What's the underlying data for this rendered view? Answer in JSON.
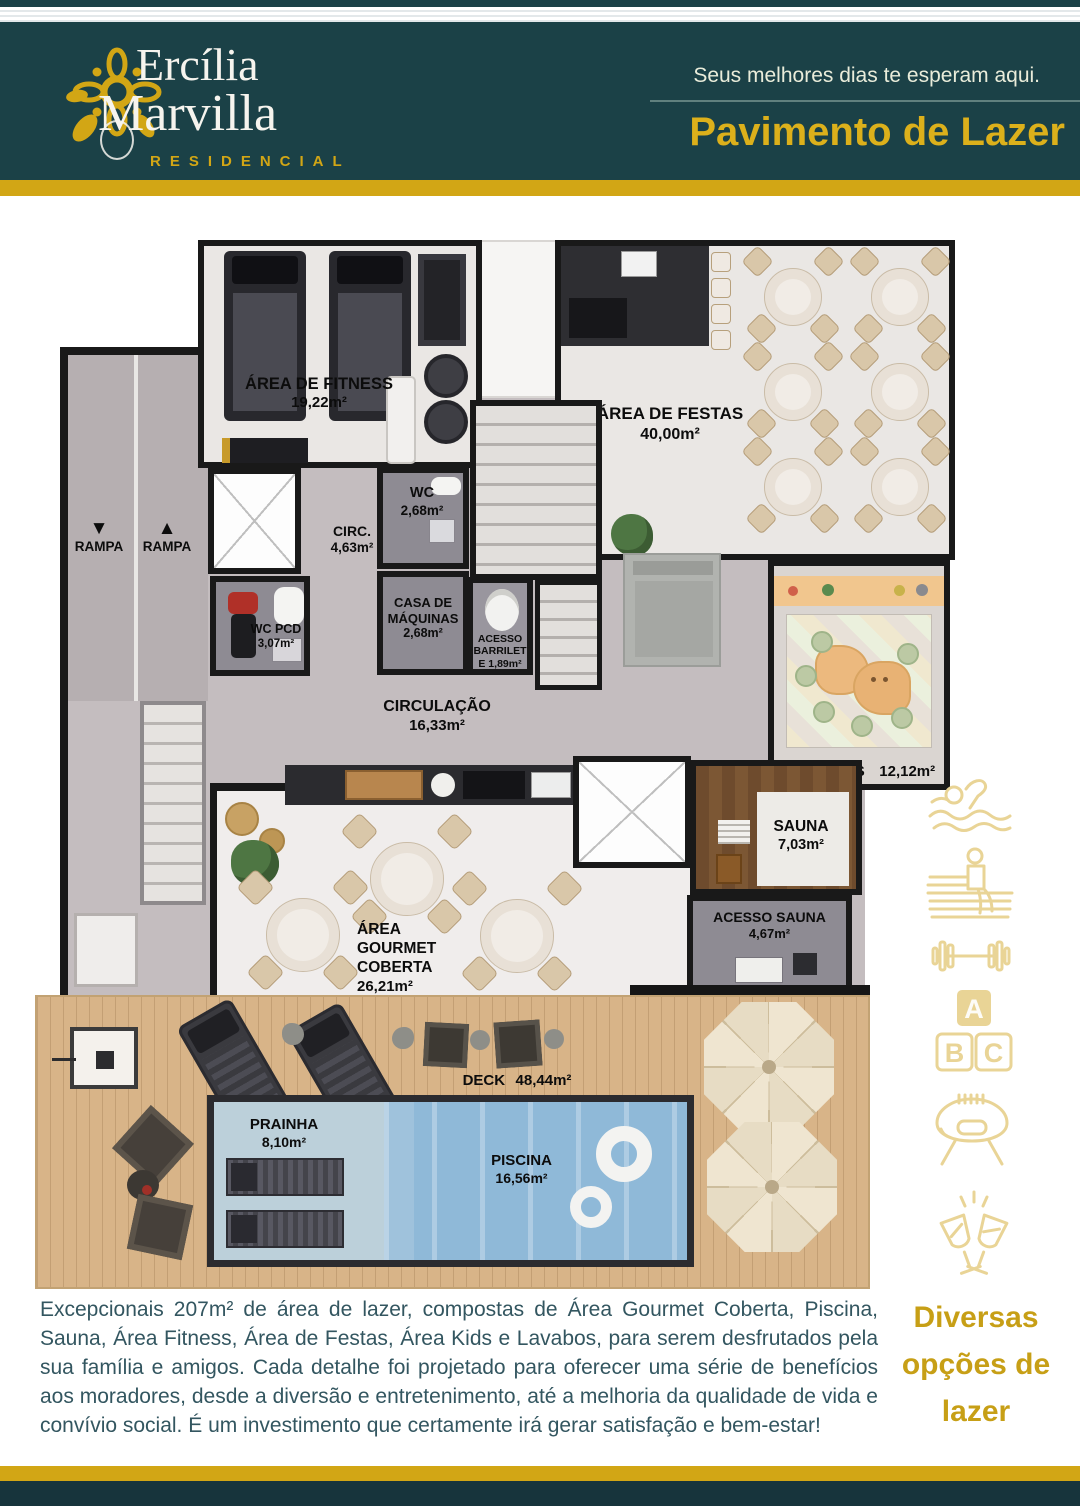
{
  "header": {
    "brand_line1": "Ercília",
    "brand_line2": "Marvilla",
    "brand_subtitle": "RESIDENCIAL",
    "tagline": "Seus melhores dias te esperam aqui.",
    "page_title": "Pavimento de Lazer"
  },
  "plan": {
    "rampa_down_arrow": "▼",
    "rampa_up_arrow": "▲",
    "rampa_down_label": "RAMPA",
    "rampa_up_label": "RAMPA",
    "rooms": {
      "fitness": {
        "name": "ÁREA DE FITNESS",
        "area": "19,22m²"
      },
      "festas": {
        "name": "ÁREA DE FESTAS",
        "area": "40,00m²"
      },
      "circ": {
        "name": "CIRC.",
        "area": "4,63m²"
      },
      "wc": {
        "name": "WC",
        "area": "2,68m²"
      },
      "wc_pcd": {
        "name": "WC PCD",
        "area": "3,07m²"
      },
      "casa_maquinas": {
        "line1": "CASA DE",
        "line2": "MÁQUINAS",
        "area": "2,68m²"
      },
      "acesso_barrilete": {
        "line1": "ACESSO",
        "line2": "BARRILET",
        "line3": "E 1,89m²"
      },
      "circulacao": {
        "name": "CIRCULAÇÃO",
        "area": "16,33m²"
      },
      "area_kids": {
        "name": "ÁREA KIDS",
        "area": "12,12m²"
      },
      "gourmet": {
        "line1": "ÁREA",
        "line2": "GOURMET",
        "line3": "COBERTA",
        "area": "26,21m²"
      },
      "sauna": {
        "name": "SAUNA",
        "area": "7,03m²"
      },
      "acesso_sauna": {
        "name": "ACESSO SAUNA",
        "area": "4,67m²"
      },
      "deck": {
        "name": "DECK",
        "area": "48,44m²"
      },
      "prainha": {
        "name": "PRAINHA",
        "area": "8,10m²"
      },
      "piscina": {
        "name": "PISCINA",
        "area": "16,56m²"
      }
    }
  },
  "amenity_icons": [
    "swimmer-icon",
    "sauna-bench-icon",
    "dumbbell-icon",
    "abc-blocks-icon",
    "bbq-grill-icon",
    "toast-glasses-icon"
  ],
  "footer": {
    "paragraph": "Excepcionais 207m² de área de lazer, compostas de Área Gourmet Coberta, Piscina, Sauna, Área Fitness, Área de Festas, Área Kids e Lavabos, para serem desfrutados pela sua família e amigos. Cada detalhe foi projetado para oferecer uma série de benefícios aos moradores, desde a diversão e entretenimento, até a melhoria da qualidade de vida e convívio social. É um investimento que certamente irá gerar satisfação e bem-estar!",
    "highlight": "Diversas opções de lazer"
  },
  "colors": {
    "header_teal": "#1b4147",
    "gold": "#d2a615",
    "title_gold": "#dcb01b",
    "icon_gold": "#e9d496",
    "body_text": "#335660",
    "pool_blue": "#8fb9d8"
  }
}
